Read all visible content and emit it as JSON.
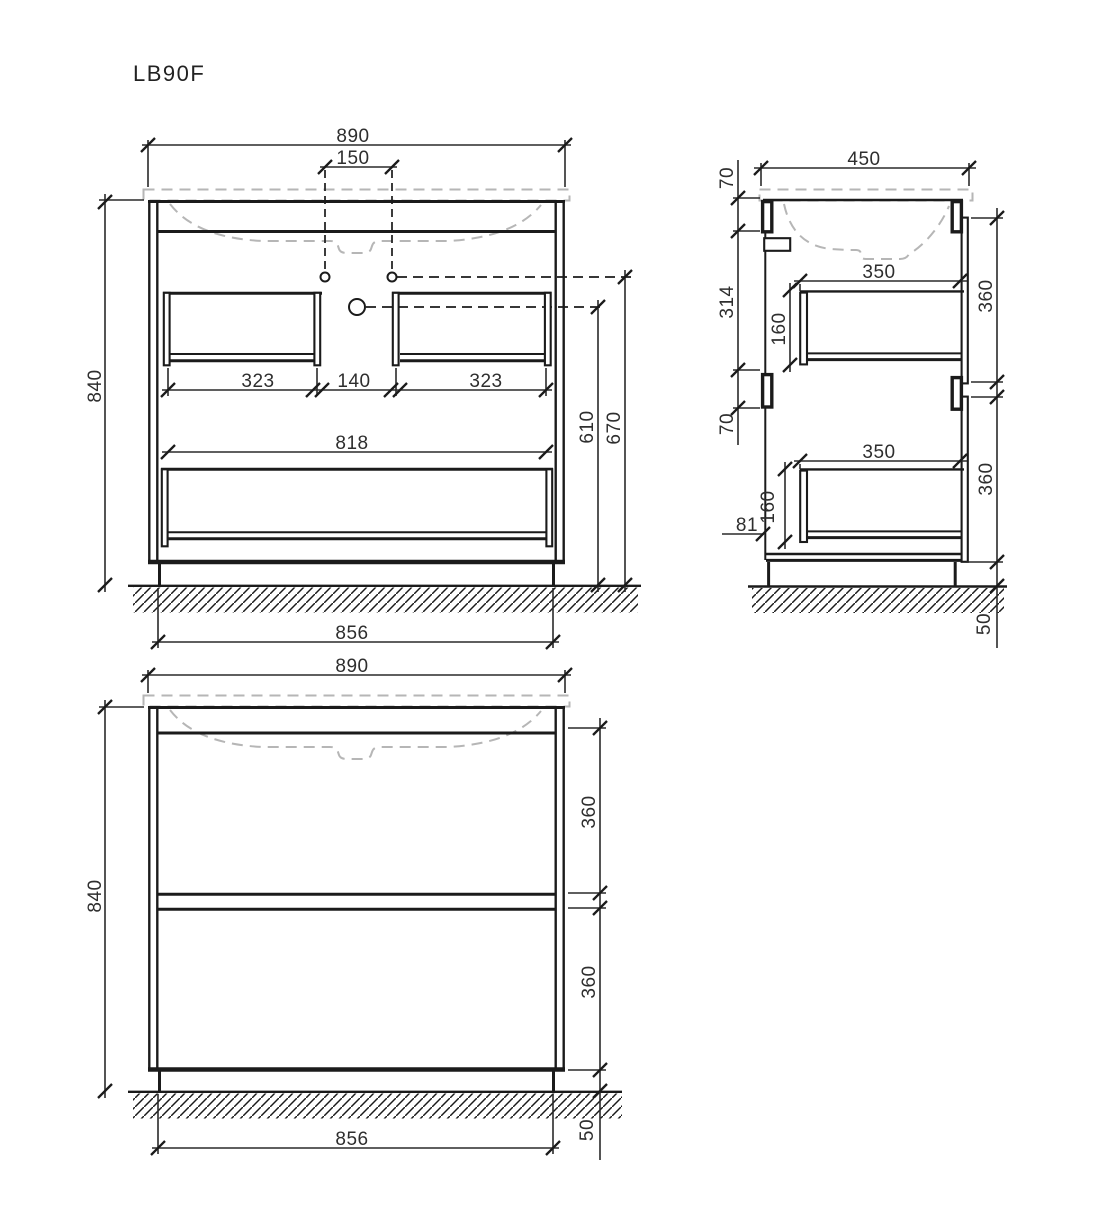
{
  "title": "LB90F",
  "views": {
    "front_open": {
      "width": "890",
      "faucet_spacing": "150",
      "height": "840",
      "left_drawer": "323",
      "center_gap": "140",
      "right_drawer": "323",
      "wide_drawer": "818",
      "drain_height": "610",
      "faucet_height": "670",
      "base_width": "856"
    },
    "side": {
      "depth": "450",
      "top_bracket": "70",
      "bracket_span": "314",
      "mid_bracket": "70",
      "top_drawer_depth": "350",
      "top_drawer_height": "160",
      "top_front": "360",
      "bottom_drawer_depth": "350",
      "bottom_drawer_height": "160",
      "bottom_offset": "81",
      "bottom_front": "360",
      "foot": "50"
    },
    "front_closed": {
      "width": "890",
      "height": "840",
      "top_front": "360",
      "bottom_front": "360",
      "base_width": "856",
      "foot": "50"
    }
  }
}
